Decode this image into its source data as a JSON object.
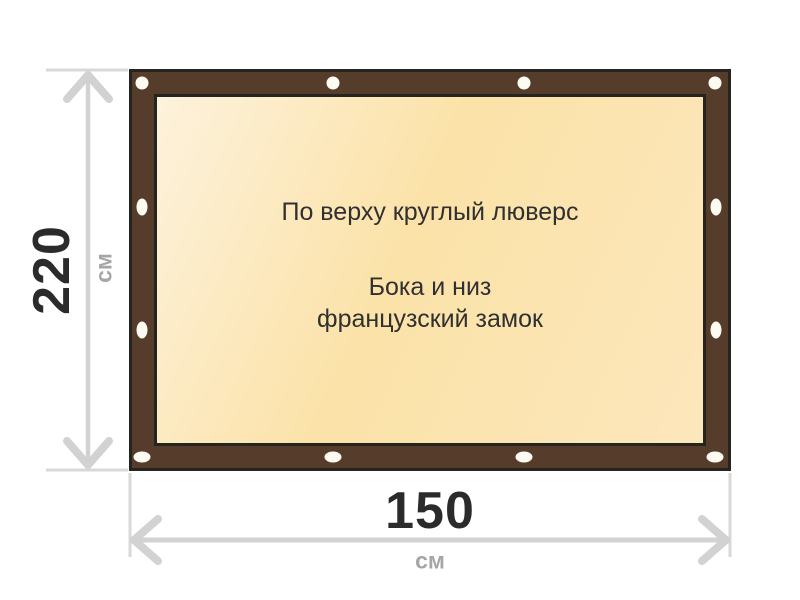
{
  "diagram": {
    "height_dimension": {
      "value": "220",
      "unit": "см"
    },
    "width_dimension": {
      "value": "150",
      "unit": "см"
    },
    "annotations": {
      "top": "По верху круглый люверс",
      "middle_line_1": "Бока и низ",
      "middle_line_2": "французский замок"
    },
    "colors": {
      "frame_brown": "#563d2b",
      "frame_outline": "#26241f",
      "canvas_cream_light": "#fdf2dc",
      "canvas_cream_gold": "#fbe2a8",
      "grommet_white": "#fdfaf1",
      "dimension_gray": "#d2d2d2",
      "extension_gray": "#d8d8d8",
      "inner_arrow_tan": "#c1b697",
      "number_dark": "#2b2b2b",
      "unit_gray": "#a6a6a6",
      "text_dark": "#303030",
      "page_background": "#ffffff"
    }
  }
}
